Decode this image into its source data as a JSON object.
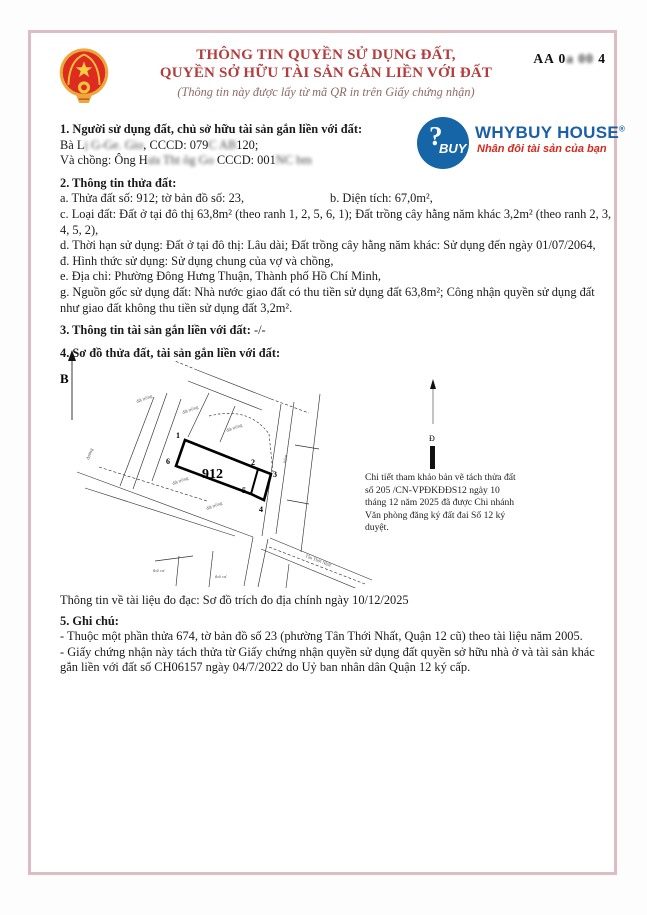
{
  "colors": {
    "frame_pink": "#debcc3",
    "title_red": "#b43c3c",
    "subtitle_mauve": "#8f6a6a",
    "brand_blue": "#1a5fa8",
    "brand_red": "#d32a1f",
    "emblem_red": "#dd2b1f",
    "emblem_gold": "#eda83b"
  },
  "header": {
    "title_line1": "THÔNG TIN QUYỀN SỬ DỤNG ĐẤT,",
    "title_line2": "QUYỀN SỞ HỮU TÀI SẢN GẮN LIỀN VỚI ĐẤT",
    "subtitle": "(Thông tin này được lấy từ mã QR in trên Giấy chứng nhận)",
    "serial_segments": [
      {
        "t": "AA 0",
        "r": false
      },
      {
        "t": "a 00",
        "r": true
      },
      {
        "t": " 4",
        "r": false
      }
    ]
  },
  "logo": {
    "badge_question": "?",
    "badge_buy": "BUY",
    "name": "WHYBUY HOUSE",
    "registered": "®",
    "tagline": "Nhân đôi tài sản của bạn"
  },
  "section1": {
    "heading": "1. Người sử dụng đất, chủ sở hữu tài sản gắn liền với đất:",
    "line1_segments": [
      {
        "t": "Bà L",
        "r": false
      },
      {
        "t": "ị G-Ge. Gio",
        "r": true
      },
      {
        "t": ", CCCD: 079",
        "r": false
      },
      {
        "t": "C  AB",
        "r": true
      },
      {
        "t": "120;",
        "r": false
      }
    ],
    "line2_segments": [
      {
        "t": "Và chồng: Ông H",
        "r": false
      },
      {
        "t": "ưa  Tht  ôg Go",
        "r": true
      },
      {
        "t": "  CCCD: 001",
        "r": false
      },
      {
        "t": "NC  bm",
        "r": true
      }
    ]
  },
  "section2": {
    "heading": "2. Thông tin thửa đất:",
    "line_a": "a. Thửa đất số: 912; tờ bản đồ số: 23,",
    "line_b": "b. Diện tích: 67,0m²,",
    "line_c": "c. Loại đất: Đất ở tại đô thị 63,8m² (theo ranh 1, 2, 5, 6, 1); Đất trồng cây hằng năm khác 3,2m² (theo ranh 2, 3, 4, 5, 2),",
    "line_d": "d. Thời hạn sử dụng: Đất ở tại đô thị: Lâu dài; Đất trồng cây hằng năm khác: Sử dụng đến ngày 01/07/2064,",
    "line_dd": "đ. Hình thức sử dụng: Sử dụng chung của vợ và chồng,",
    "line_e": "e. Địa chỉ: Phường Đông Hưng Thuận, Thành phố Hồ Chí Minh,",
    "line_g": "g. Nguồn gốc sử dụng đất: Nhà nước giao đất có thu tiền sử dụng đất 63,8m²; Công nhận quyền sử dụng đất như giao đất không thu tiền sử dụng đất 3,2m²."
  },
  "section3": {
    "heading": "3. Thông tin tài sản gắn liền với đất:",
    "value": "-/-"
  },
  "section4": {
    "heading": "4. Sơ đồ thửa đất, tài sản gắn liền với đất:"
  },
  "map": {
    "north_label": "B",
    "detail_north_label": "Đ",
    "parcel_number": "912",
    "vertices": [
      "1",
      "2",
      "3",
      "4",
      "5",
      "6"
    ],
    "area_labels": [
      "đất trống",
      "đất trống",
      "đất trống",
      "đất trống",
      "đất trống",
      "thổ cư",
      "thổ cư"
    ],
    "street_left": "đường",
    "alley_right": "hẻm",
    "road_bottom": "Tân Thới Nhất",
    "note": "Chi tiết tham khảo bản vẽ tách thửa đất số  205 /CN-VPĐKĐĐS12 ngày 10 tháng 12 năm 2025 đã được Chi nhánh Văn phòng đăng ký đất đai Số 12 ký duyệt."
  },
  "measurement": "Thông tin về tài liệu đo đạc: Sơ đồ trích đo địa chính ngày 10/12/2025",
  "section5": {
    "heading": "5. Ghi chú:",
    "item1": "- Thuộc một phần thửa 674, tờ bản đồ số 23 (phường Tân Thới Nhất, Quận 12 cũ) theo tài liệu năm 2005.",
    "item2": "- Giấy chứng nhận này tách thửa từ Giấy chứng nhận quyền sử dụng đất quyền sở hữu nhà ở và tài sản khác gắn liền với đất số CH06157 ngày 04/7/2022 do Uỷ ban nhân dân Quận 12 ký cấp."
  }
}
